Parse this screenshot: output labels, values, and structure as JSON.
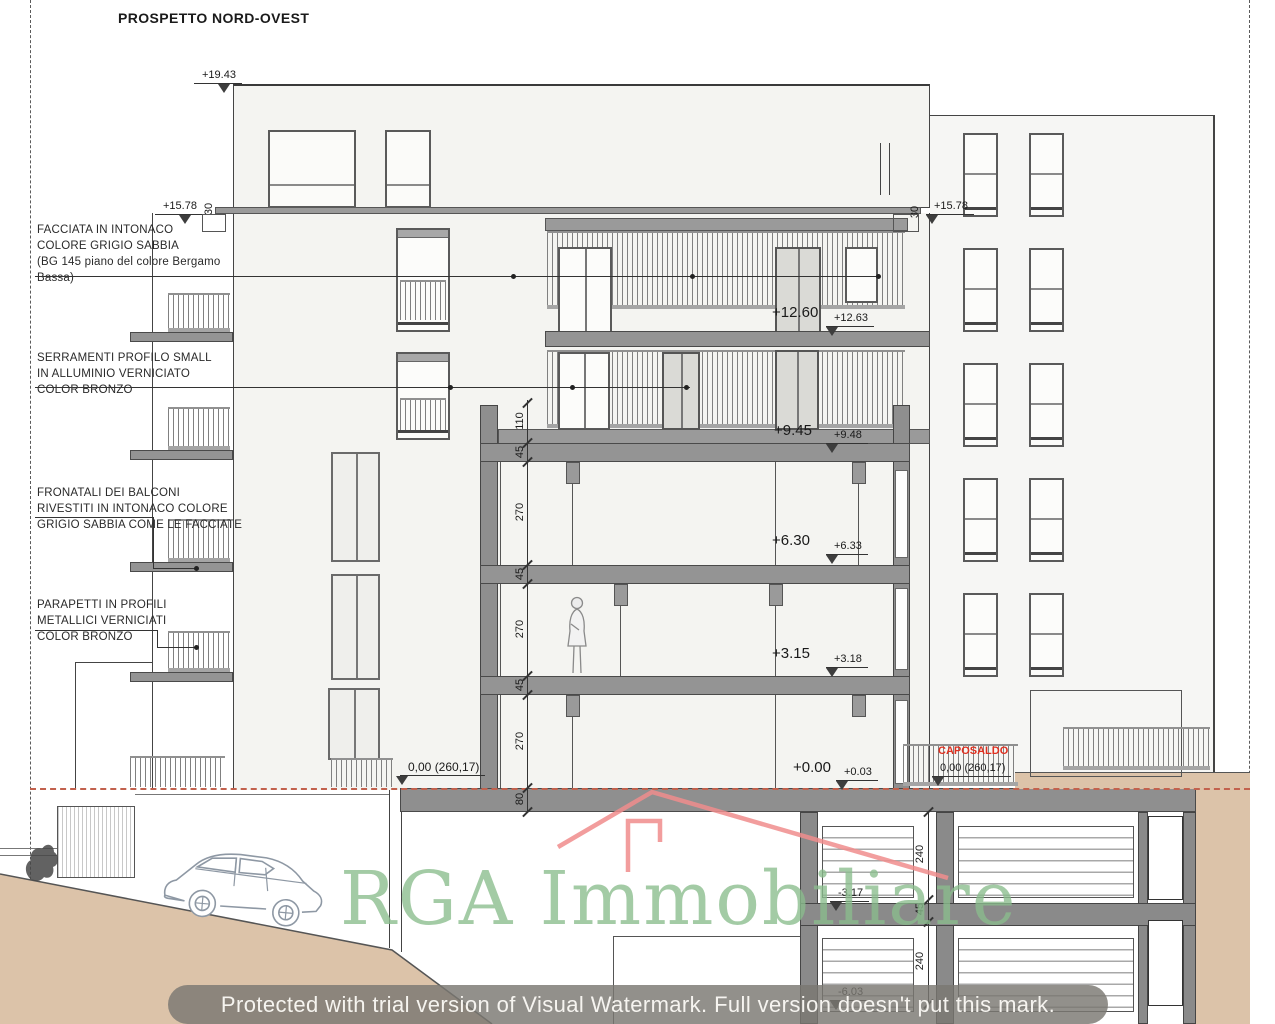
{
  "title": "PROSPETTO NORD-OVEST",
  "annotations": {
    "facciata": "FACCIATA IN INTONACO\nCOLORE GRIGIO SABBIA\n(BG 145 piano del colore Bergamo\nBassa)",
    "serramenti": "SERRAMENTI PROFILO SMALL\nIN ALLUMINIO VERNICIATO\nCOLOR BRONZO",
    "fronatali": "FRONATALI DEI BALCONI\nRIVESTITI IN INTONACO COLORE\nGRIGIO SABBIA COME LE FACCIATE",
    "parapetti": "PARAPETTI IN PROFILI\nMETALLICI VERNICIATI\nCOLOR BRONZO"
  },
  "levels": {
    "p1943": "+19.43",
    "p1578L": "+15.78",
    "p1578R": "+15.78",
    "p1260": "+12.60",
    "p1263": "+12.63",
    "p945": "+9.45",
    "p948": "+9.48",
    "p630": "+6.30",
    "p633": "+6.33",
    "p315": "+3.15",
    "p318": "+3.18",
    "p000": "+0.00",
    "p003": "+0.03",
    "zero_left": "0,00 (260,17)",
    "m317": "-3.17",
    "m603": "-6.03"
  },
  "caposaldo": {
    "label": "CAPOSALDO",
    "value": "0,00 (260,17)"
  },
  "dims": {
    "t30L": "30",
    "t30R": "30",
    "center": [
      "110",
      "45",
      "270",
      "45",
      "270",
      "45",
      "270",
      "80"
    ],
    "right": [
      "240",
      "45",
      "240"
    ]
  },
  "watermark": {
    "text": "RGA Immobiliare"
  },
  "banner": {
    "text": "Protected with trial version of Visual Watermark. Full version doesn't put this mark."
  },
  "colors": {
    "watermark_green": "#8abd8d",
    "roof_red": "#f08d8d",
    "caposaldo_red": "#e03020",
    "terrain_tan": "#dcc3a9",
    "slab_gray": "#949494",
    "ground_line_red": "#c2614d"
  }
}
